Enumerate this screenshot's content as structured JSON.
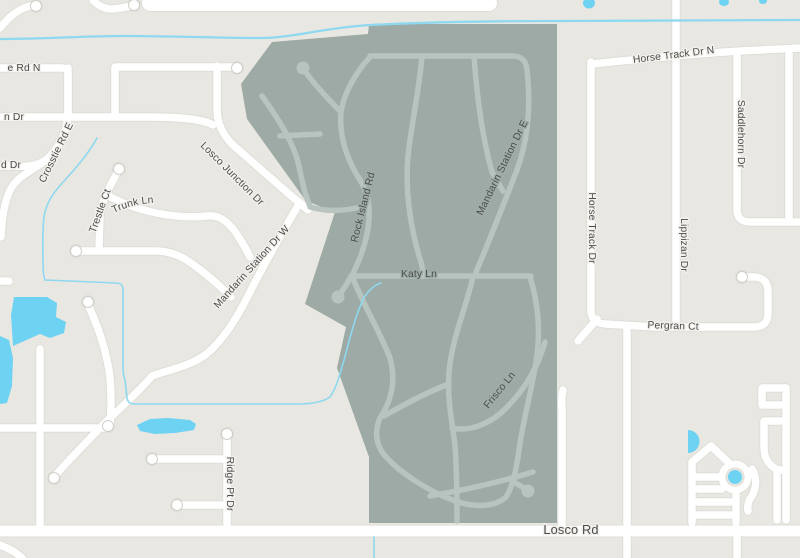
{
  "map": {
    "type": "street-map with highlighted neighborhood region",
    "labels": {
      "e_rd_n": "e Rd N",
      "n_dr": "n Dr",
      "d_dr": "d Dr",
      "crosstie": "Crosstie Rd E",
      "losco_junction": "Losco Junction Dr",
      "grand_trunk": "Grand Trunk Ln",
      "trestle": "Trestle Ct",
      "mandarin_w": "Mandarin Station Dr W",
      "ridge_pt": "Ridge Pt Dr",
      "horse_track_n": "Horse Track Dr N",
      "saddlehorn": "Saddlehorn Dr",
      "horse_track": "Horse Track Dr",
      "lippizan": "Lippizan Dr",
      "pergran": "Pergran Ct",
      "losco_rd": "Losco Rd",
      "rock_island": "Rock Island Rd",
      "katy": "Katy Ln",
      "mandarin_e": "Mandarin Station Dr E",
      "frisco": "Frisco Ln"
    },
    "colors": {
      "background": "#e9e7e1",
      "road": "#ffffff",
      "road_casing": "#d2d0cb",
      "region_fill": "#9daaa6",
      "region_road": "#b8c4c0",
      "water": "#6ed2f2",
      "stream": "#8ed8f0",
      "label": "#4c4c4c",
      "label_halo_outside": "#f3f1ec",
      "label_halo_inside": "#9fada9"
    }
  }
}
